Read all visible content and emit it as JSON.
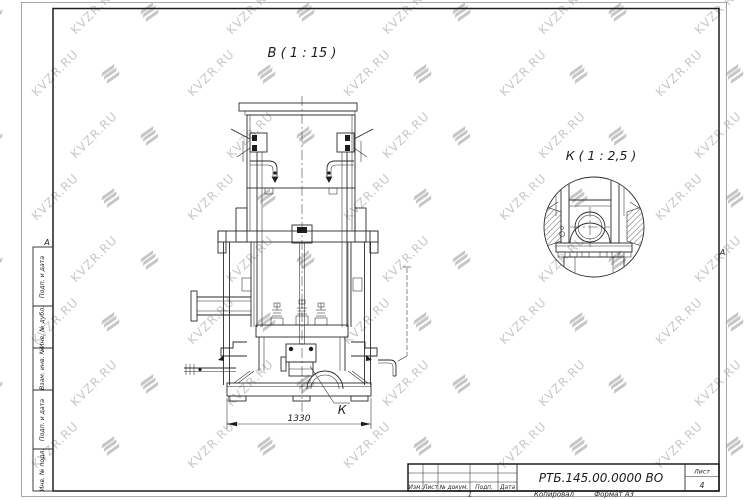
{
  "page": {
    "paper_edge_color": "#a8a8a8",
    "frame_color": "#1d1d1d",
    "line_color": "#2b2b2b"
  },
  "watermark": {
    "text": "KVZR.RU",
    "color": "#c8c8c8"
  },
  "views": {
    "main_view_label": "В ( 1 : 15 )",
    "detail_view_label": "К ( 1 : 2,5 )",
    "detail_ref_label": "К",
    "dimension_1330": "1330"
  },
  "title_block": {
    "doc_number": "РТБ.145.00.0000 ВО",
    "sheet_label": "Лист",
    "sheet_number": "4",
    "columns": [
      "Изм.",
      "Лист",
      "№ докум.",
      "Подп.",
      "Дата"
    ],
    "footer": {
      "left": "1",
      "copied": "Копировал",
      "format": "Формат А3"
    }
  },
  "side_stamps": [
    "Подп. и дата",
    "Инв. № дубл.",
    "Взам. инв. №",
    "Подп. и дата",
    "Инв. № подл."
  ],
  "fold_marks": {
    "left": "А",
    "right": "А"
  }
}
